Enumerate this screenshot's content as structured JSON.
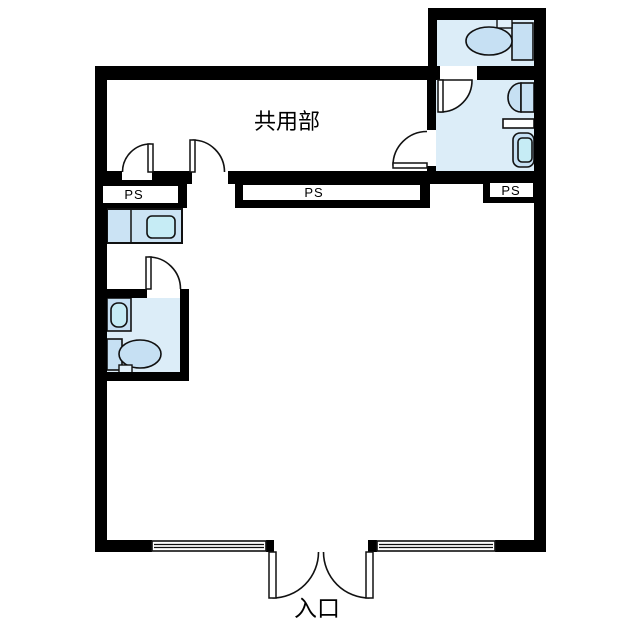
{
  "plan": {
    "title": "floor-plan",
    "labels": {
      "common_area": "共用部",
      "entrance": "入口",
      "ps_left": "PS",
      "ps_center": "PS",
      "ps_right": "PS"
    },
    "rooms": [
      "common-area-corridor",
      "main-tenant-room",
      "toilet-room-top-right",
      "bathroom-right",
      "washroom-left",
      "entrance-bottom"
    ],
    "fixtures": [
      "toilet-icon",
      "toilet-tank-icon",
      "washbasin-icon",
      "shelf-icon",
      "bathtub-icon",
      "kitchen-counter-icon",
      "kitchen-sink-icon",
      "vanity-sink-icon"
    ],
    "door_count": 7,
    "window_count": 2
  },
  "colors": {
    "background": "#ffffff",
    "wall": "#000000",
    "line": "#111111",
    "room_fill": "#dcedf8",
    "fixture_fill": "#c6e0f3",
    "fixture_light": "#e2f0fa",
    "basin_fill": "#c6ecf5",
    "counter_fill": "#cbe3f4"
  }
}
